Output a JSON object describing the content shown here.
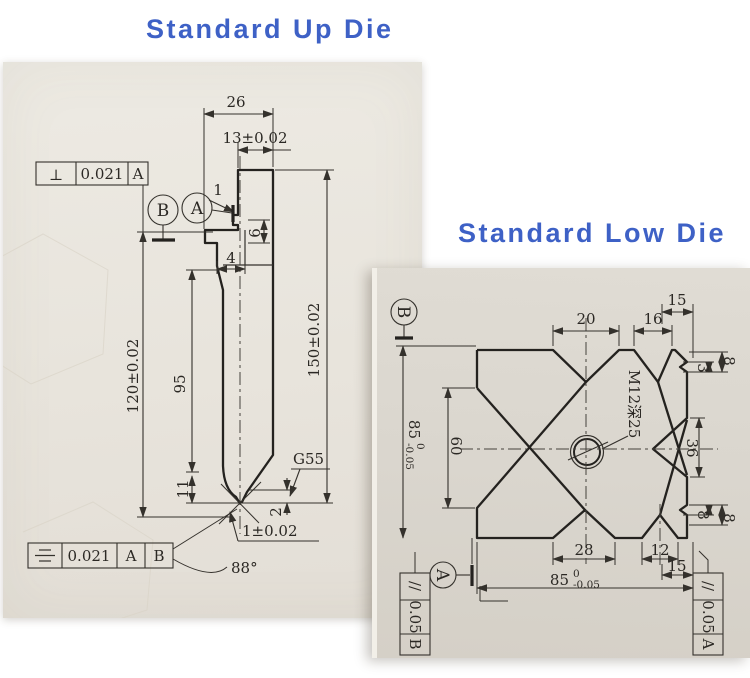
{
  "titles": {
    "up": "Standard Up Die",
    "low": "Standard Low Die"
  },
  "up": {
    "dims": {
      "width_top": "26",
      "width_tang": "13±0.02",
      "notch": "1",
      "step6": "6",
      "step4": "4",
      "height_left": "120±0.02",
      "height_mid": "95",
      "height_right": "150±0.02",
      "blade": "11",
      "tip_land": "2",
      "tip_width": "1±0.02",
      "tip_angle": "88°",
      "code": "G55"
    },
    "fcf_top": {
      "symbol": "⊥",
      "value": "0.021",
      "datum": "A"
    },
    "fcf_bottom": {
      "symbol_icon": "symmetry-icon",
      "value": "0.021",
      "datum_1": "A",
      "datum_2": "B"
    },
    "datum_circles": {
      "b": "B",
      "a": "A"
    }
  },
  "low": {
    "dims": {
      "top_15": "15",
      "top_20": "20",
      "top_16": "16",
      "tr_8": "8",
      "tr_3": "3",
      "right_36": "36",
      "left_85": "85",
      "left_85_upper": "0",
      "left_85_lower": "-0.05",
      "left_60": "60",
      "bottom_28": "28",
      "bottom_12": "12",
      "br_8_inner": "8",
      "br_8_outer": "8",
      "bottom_15": "15",
      "bottom_85": "85",
      "bottom_85_upper": "0",
      "bottom_85_lower": "-0.05",
      "thread_note": "M12深25"
    },
    "fcf_left": {
      "symbol": "//",
      "value": "0.05",
      "datum": "B"
    },
    "fcf_right": {
      "symbol": "//",
      "value": "0.05",
      "datum": "A"
    },
    "datum_circles": {
      "b": "B",
      "a": "A"
    }
  }
}
